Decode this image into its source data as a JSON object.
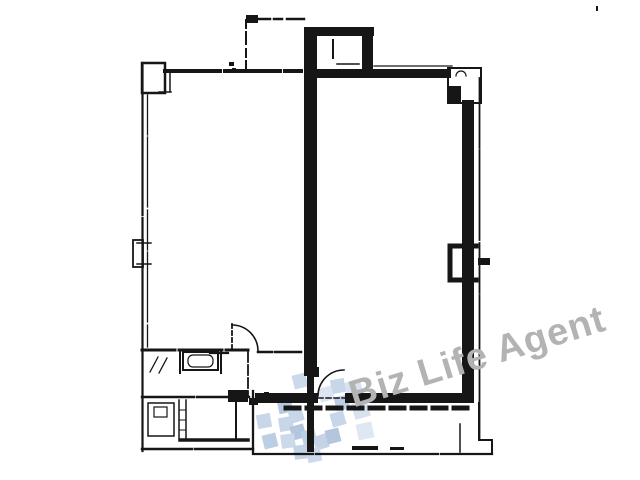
{
  "page": {
    "background_color": "#ffffff"
  },
  "drawing": {
    "type": "floor-plan",
    "ink_color": "#161616"
  },
  "watermark": {
    "text": "Biz Life Agent",
    "color": "#b3b3b3"
  },
  "logo": {
    "label": "tiled-cube-logo",
    "tile_colors": [
      "#c7d6e8",
      "#b3c6de",
      "#d8e1ef"
    ]
  }
}
